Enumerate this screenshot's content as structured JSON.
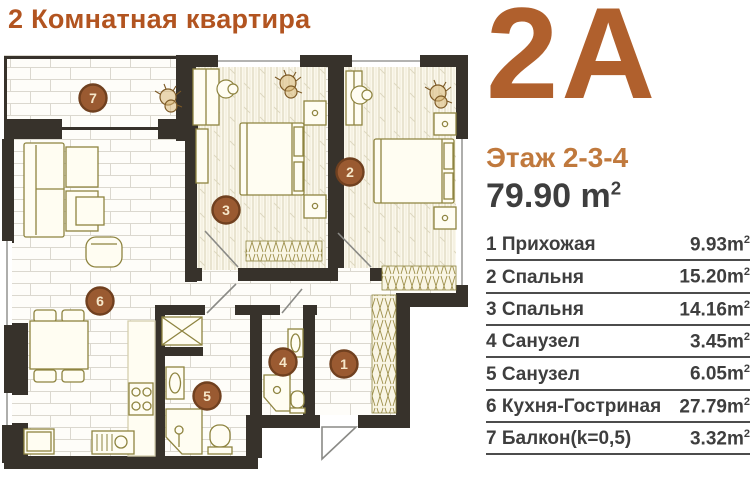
{
  "title": "2 Комнатная квартира",
  "unit": {
    "code": "2A",
    "floor": "Этаж 2-3-4",
    "total_area": "79.90",
    "unit_base": "m",
    "unit_sup": "2"
  },
  "rooms": [
    {
      "num": "1",
      "name": "1 Прихожая",
      "area": "9.93"
    },
    {
      "num": "2",
      "name": "2 Спальня",
      "area": "15.20"
    },
    {
      "num": "3",
      "name": "3 Спальня",
      "area": "14.16"
    },
    {
      "num": "4",
      "name": "4 Санузел",
      "area": "3.45"
    },
    {
      "num": "5",
      "name": "5 Санузел",
      "area": "6.05"
    },
    {
      "num": "6",
      "name": "6 Кухня-Гостриная",
      "area": "27.79"
    },
    {
      "num": "7",
      "name": "7 Балкон(k=0,5)",
      "area": "3.32"
    }
  ],
  "colors": {
    "accent": "#b25420",
    "accent_light": "#c0793d",
    "text_dark": "#3e3e3e",
    "wall": "#37322b",
    "badge_fill": "#9a5a31",
    "badge_ring": "#70401f",
    "furniture_line": "#8e8440"
  }
}
